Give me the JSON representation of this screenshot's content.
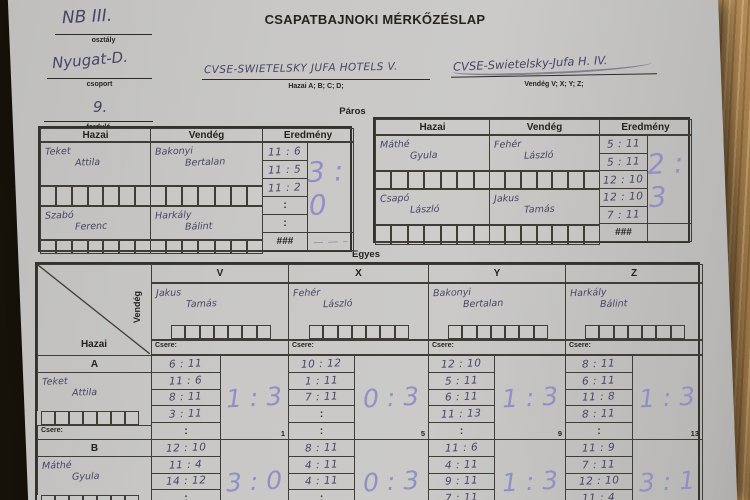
{
  "misc": {
    "colon": ":",
    "dash": "— — –"
  },
  "colors": {
    "ink": "#474566",
    "result_ink": "#918fc6",
    "paper": "#c7c6c4",
    "wood": "#a07c4e",
    "print": "#26231e"
  },
  "header": {
    "title": "CSAPATBAJNOKI MÉRKŐZÉSLAP",
    "fields": [
      {
        "value": "NB III.",
        "label": "osztály"
      },
      {
        "value": "Nyugat-D.",
        "label": "csoport"
      },
      {
        "value": "9.",
        "label": "forduló"
      }
    ],
    "teams": {
      "home": {
        "name": "CVSE-SWIETELSKY JUFA HOTELS V.",
        "caption": "Hazai A; B; C; D;"
      },
      "away": {
        "name": "CVSE-Swietelsky-Jufa H. IV.",
        "caption": "Vendég V; X; Y; Z;"
      }
    }
  },
  "paros": {
    "label": "Páros",
    "headers": {
      "home": "Hazai",
      "away": "Vendég",
      "result": "Eredmény"
    },
    "tables": [
      {
        "pairs": [
          {
            "home": [
              "Teket",
              "Attila"
            ],
            "away": [
              "Bakonyi",
              "Bertalan"
            ]
          },
          {
            "home": [
              "Szabó",
              "Ferenc"
            ],
            "away": [
              "Harkály",
              "Bálint"
            ]
          }
        ],
        "games": [
          "11 : 6",
          "11 : 5",
          "11 : 2",
          "",
          ""
        ],
        "last_cell": "###",
        "result": "3 : 0",
        "dash_note": "— — –"
      },
      {
        "pairs": [
          {
            "home": [
              "Máthé",
              "Gyula"
            ],
            "away": [
              "Fehér",
              "László"
            ]
          },
          {
            "home": [
              "Csapó",
              "László"
            ],
            "away": [
              "Jakus",
              "Tamás"
            ]
          }
        ],
        "games": [
          "5 : 11",
          "5 : 11",
          "12 : 10",
          "12 : 10",
          "7 : 11"
        ],
        "last_cell": "###",
        "result": "2 : 3",
        "dash_note": ""
      }
    ]
  },
  "egyes": {
    "label": "Egyes",
    "corner": {
      "home": "Hazai",
      "away": "Vendég"
    },
    "csere_label": "Csere:",
    "columns": [
      {
        "key": "V",
        "player": [
          "Jakus",
          "Tamás"
        ]
      },
      {
        "key": "X",
        "player": [
          "Fehér",
          "László"
        ]
      },
      {
        "key": "Y",
        "player": [
          "Bakonyi",
          "Bertalan"
        ]
      },
      {
        "key": "Z",
        "player": [
          "Harkály",
          "Bálint"
        ]
      }
    ],
    "rows": [
      {
        "key": "A",
        "player": [
          "Teket",
          "Attila"
        ],
        "cells": [
          {
            "games": [
              "6 : 11",
              "11 : 6",
              "8 : 11",
              "3 : 11",
              ""
            ],
            "result": "1 : 3",
            "num": "1"
          },
          {
            "games": [
              "10 : 12",
              "1 : 11",
              "7 : 11",
              "",
              ""
            ],
            "result": "0 : 3",
            "num": "5"
          },
          {
            "games": [
              "12 : 10",
              "5 : 11",
              "6 : 11",
              "11 : 13",
              ""
            ],
            "result": "1 : 3",
            "num": "9"
          },
          {
            "games": [
              "8 : 11",
              "6 : 11",
              "11 : 8",
              "8 : 11",
              ""
            ],
            "result": "1 : 3",
            "num": "13"
          }
        ]
      },
      {
        "key": "B",
        "player": [
          "Máthé",
          "Gyula"
        ],
        "cells": [
          {
            "games": [
              "12 : 10",
              "11 : 4",
              "14 : 12",
              "",
              ""
            ],
            "result": "3 : 0",
            "num": ""
          },
          {
            "games": [
              "8 : 11",
              "4 : 11",
              "4 : 11",
              "",
              ""
            ],
            "result": "0 : 3",
            "num": ""
          },
          {
            "games": [
              "11 : 6",
              "4 : 11",
              "9 : 11",
              "7 : 11",
              ""
            ],
            "result": "1 : 3",
            "num": ""
          },
          {
            "games": [
              "11 : 9",
              "7 : 11",
              "12 : 10",
              "11 : 4",
              ""
            ],
            "result": "3 : 1",
            "num": ""
          }
        ]
      }
    ]
  }
}
